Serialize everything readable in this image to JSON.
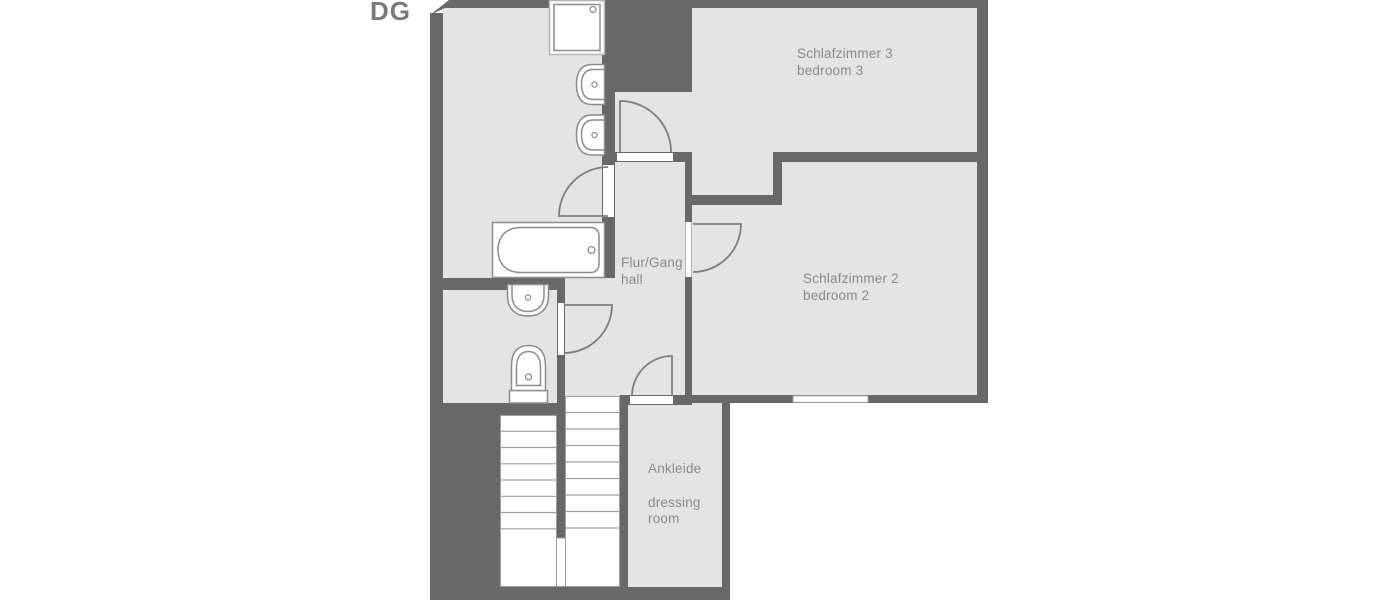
{
  "floor_plan": {
    "floor_label": "DG",
    "rooms": {
      "bedroom3": {
        "name_de": "Schlafzimmer 3",
        "name_en": "bedroom 3"
      },
      "bedroom2": {
        "name_de": "Schlafzimmer 2",
        "name_en": "bedroom 2"
      },
      "hall": {
        "name_de": "Flur/Gang",
        "name_en": "hall"
      },
      "dressing_room": {
        "name_de": "Ankleide",
        "name_en": "dressing room"
      }
    },
    "colors": {
      "wall": "#686868",
      "floor": "#e4e4e4",
      "fixture_outline": "#8c8c8c",
      "label_text": "#8a8a8a",
      "background": "#ffffff"
    }
  }
}
